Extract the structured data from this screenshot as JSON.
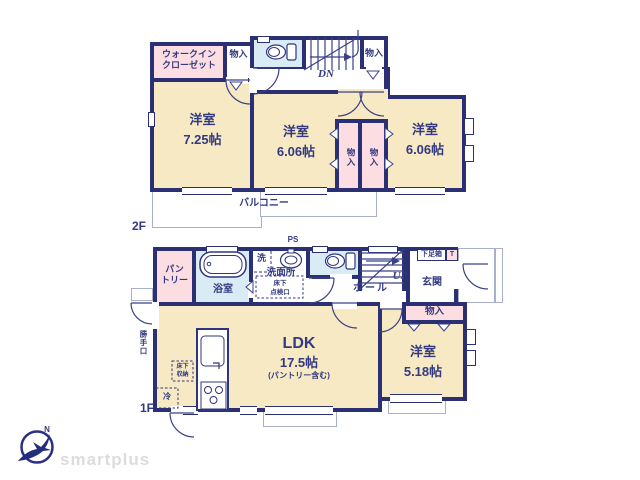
{
  "colors": {
    "wall": "#2b2f74",
    "text": "#333a80",
    "room_fill": "#f6e9c4",
    "closet_fill": "#fbdde2",
    "wet_fill": "#d9ebf5",
    "thin_outline": "#a9b0cb",
    "brand_gray": "#dcdcdc"
  },
  "floor2": {
    "label": "2F",
    "walk_in_closet": "ウォークイン\nクローゼット",
    "closet_top_left": "物入",
    "closet_top_right": "物入",
    "stairs_label": "DN",
    "rooms": [
      {
        "name": "洋室",
        "size": "7.25帖"
      },
      {
        "name": "洋室",
        "size": "6.06帖"
      },
      {
        "name": "洋室",
        "size": "6.06帖"
      }
    ],
    "closet_mid_left": "物入",
    "closet_mid_right": "物入",
    "balcony": "バルコニー"
  },
  "floor1": {
    "label": "1F",
    "pantry": "パン\nトリー",
    "bathroom": "浴室",
    "laundry": "洗",
    "washroom": "洗面所",
    "underfloor_access": "床下\n点検口",
    "pipe_space": "PS",
    "hall": "ホール",
    "stairs_label": "UP",
    "shoe_box": "下足箱",
    "shoe_box_t": "T",
    "entrance": "玄関",
    "closet": "物入",
    "ldk": {
      "name": "LDK",
      "size": "17.5帖",
      "note": "(パントリー含む)"
    },
    "bedroom": {
      "name": "洋室",
      "size": "5.18帖"
    },
    "underfloor_storage": "床下\n収納",
    "fridge": "冷",
    "back_door": "勝手口"
  },
  "footer": {
    "brand": "smartplus",
    "compass_north": "N"
  }
}
